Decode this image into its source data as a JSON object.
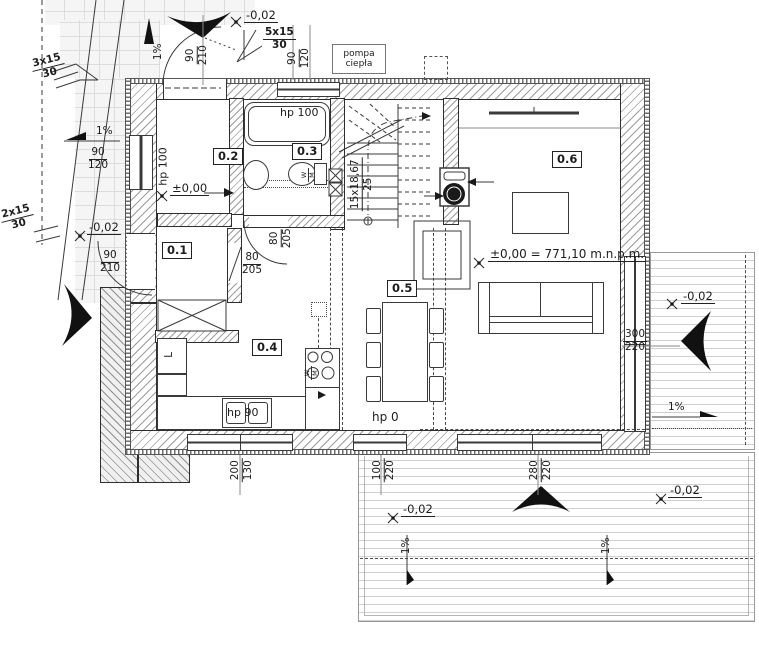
{
  "colors": {
    "line": "#333333",
    "hatch": "#9a9a9a",
    "deck_line": "#cfcfcf"
  },
  "rooms": {
    "r01": "0.1",
    "r02": "0.2",
    "r03": "0.3",
    "r04": "0.4",
    "r05": "0.5",
    "r06": "0.6"
  },
  "levels": {
    "zero": "±0,00",
    "zero_full": "±0,00 = 771,10 m.n.p.m.",
    "minus": "-0,02"
  },
  "slope": "1%",
  "ext_stairs": {
    "top_left": {
      "steps": "3x15",
      "rise": "30"
    },
    "top": {
      "steps": "5x15",
      "rise": "30"
    },
    "left": {
      "steps": "2x15",
      "rise": "30"
    }
  },
  "stairs": {
    "count_height": "15x18,67",
    "tread": "25"
  },
  "equipment": {
    "heat_pump": [
      "pompa",
      "ciepła"
    ],
    "fridge": "L",
    "wm": {
      "top": "W",
      "bottom": "M"
    }
  },
  "heights": {
    "hp100": "hp 100",
    "hp90": "hp 90",
    "hp0": "hp 0"
  },
  "dims": {
    "door_top": {
      "w": "90",
      "h": "210"
    },
    "window_top": {
      "w": "90",
      "h": "120"
    },
    "window_left": {
      "w": "90",
      "h": "120"
    },
    "door_left": {
      "w": "90",
      "h": "210"
    },
    "door_hall": {
      "w": "80",
      "h": "205"
    },
    "door_bath": {
      "w": "80",
      "h": "205"
    },
    "window_kitchen": {
      "w": "200",
      "h": "130"
    },
    "window_dining": {
      "w": "100",
      "h": "220"
    },
    "window_terrace": {
      "w": "280",
      "h": "220"
    },
    "window_living": {
      "w": "300",
      "h": "220"
    }
  }
}
